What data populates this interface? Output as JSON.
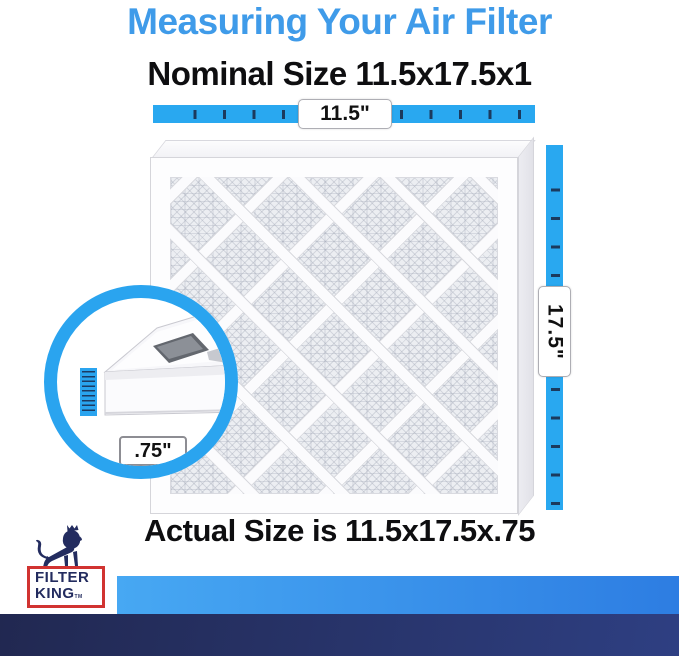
{
  "page": {
    "title": "Measuring Your Air Filter",
    "nominal_heading": "Nominal Size 11.5x17.5x1",
    "actual_heading": "Actual Size is 11.5x17.5x.75"
  },
  "measurements": {
    "width_label": "11.5\"",
    "height_label": "17.5\"",
    "depth_label": ".75\""
  },
  "brand": {
    "name_line1": "FILTER",
    "name_line2": "KING",
    "trademark": "TM",
    "logo_icon": "lion-crown-icon"
  },
  "colors": {
    "title_blue": "#3F9BE9",
    "ruler_blue": "#29A8F0",
    "tick_navy": "#1B3A5E",
    "brand_navy": "#232C5F",
    "brand_red": "#D13331",
    "bar_light_gradient_start": "#47A8F3",
    "bar_light_gradient_end": "#2D7DE2",
    "bar_navy_gradient_start": "#212851",
    "bar_navy_gradient_end": "#2E3F82"
  }
}
